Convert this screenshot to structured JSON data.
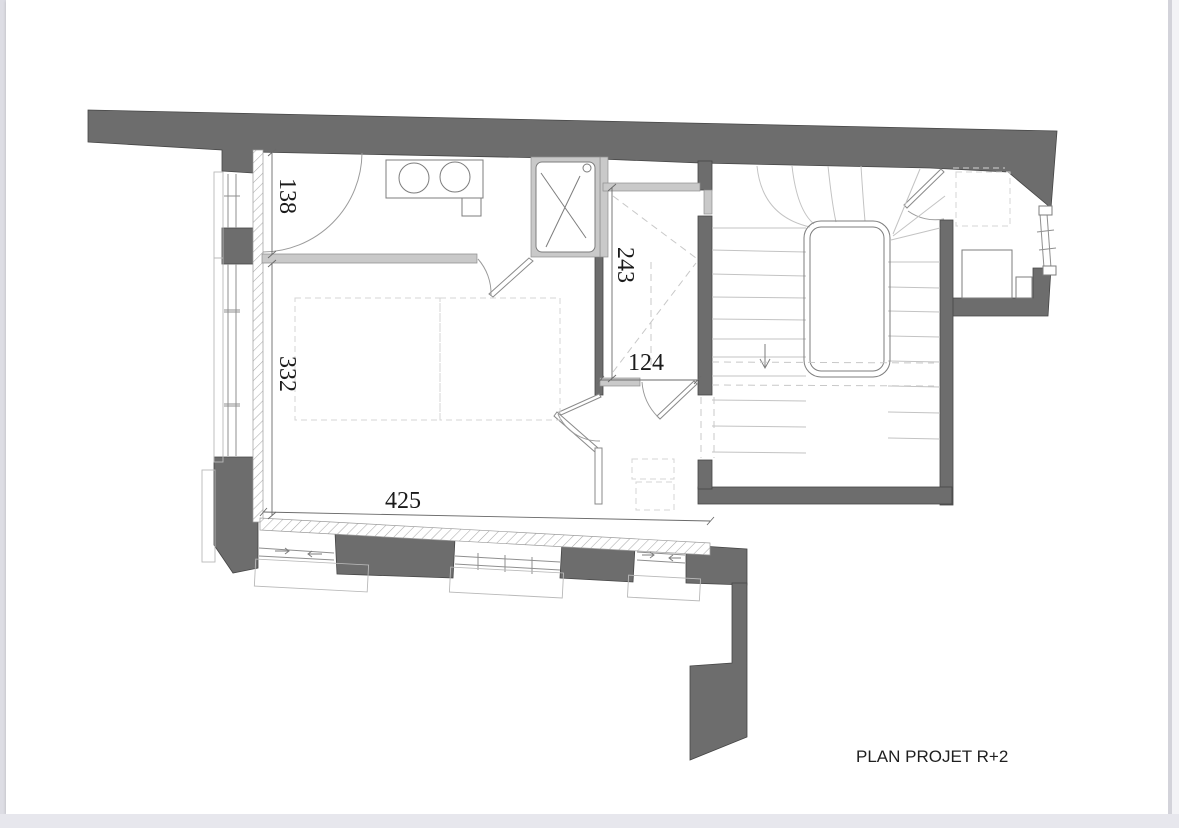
{
  "plan": {
    "caption": "PLAN PROJET R+2",
    "dimensions": {
      "entry_depth": "138",
      "corridor_length": "243",
      "bedroom_depth": "332",
      "hall_width": "124",
      "bedroom_width": "425"
    },
    "colors": {
      "wall": "#6d6d6d",
      "partition": "#c9c9c9",
      "paper": "#ffffff",
      "backdrop": "#ebebf0"
    }
  }
}
